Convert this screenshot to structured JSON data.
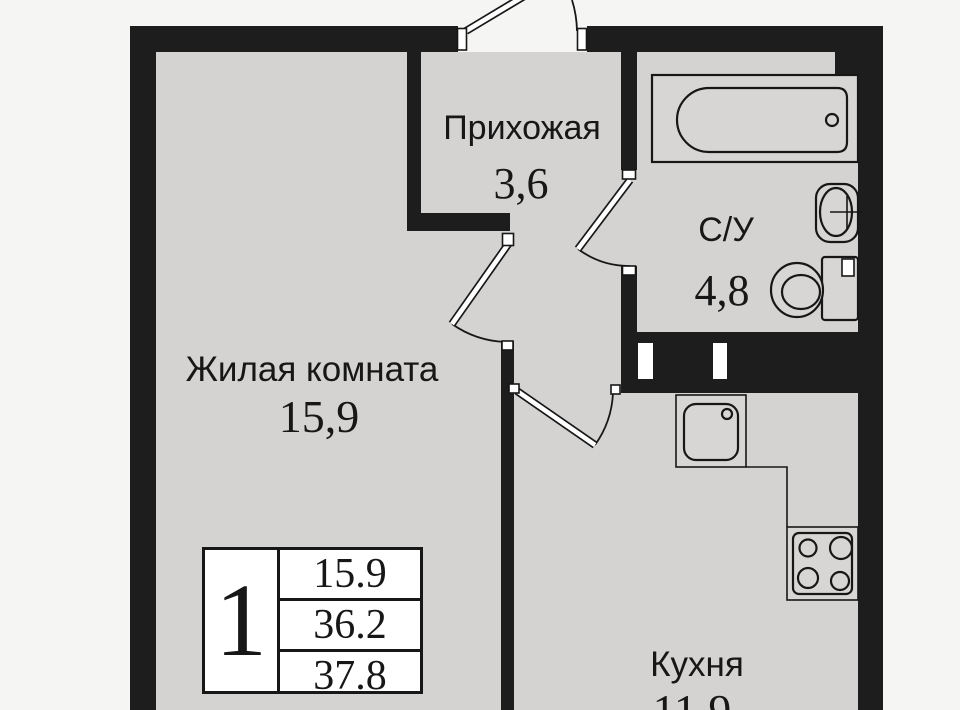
{
  "plan": {
    "rooms": {
      "living": {
        "name": "Жилая комната",
        "area": "15,9"
      },
      "hallway": {
        "name": "Прихожая",
        "area": "3,6"
      },
      "bathroom": {
        "name": "С/У",
        "area": "4,8"
      },
      "kitchen": {
        "name": "Кухня",
        "area": "11,9"
      }
    },
    "info_table": {
      "rooms_count": "1",
      "rows": [
        "15.9",
        "36.2",
        "37.8"
      ]
    }
  },
  "colors": {
    "wall": "#1d1d1d",
    "floor": "#d4d3d1",
    "outside": "#f5f5f4",
    "fixture": "#d7d6d4",
    "table-bg": "#ffffff",
    "ink": "#171717"
  }
}
